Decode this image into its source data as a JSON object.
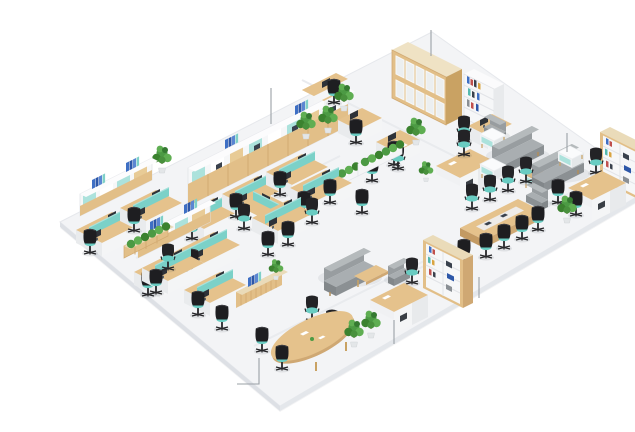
{
  "scene": {
    "type": "3d-isometric-office-render",
    "description": "Isometric 3D rendering of an open-plan office floor: rows of workstations with monitors, teal privacy screens and black task chairs, high storage walls and bookcases, planter hedges, a gray sofa lounge, executive desks, conference and meeting tables on a white floor slab. Thin gray callout lines point at key furniture groups.",
    "background_color": "#ffffff"
  },
  "floor": {
    "points": "20,206 392,16 612,172 240,390",
    "top_color": "#f3f4f6",
    "edge_color": "#e0e3e8"
  },
  "palette": {
    "wood_light": "#e5c28c",
    "wood_mid": "#e2bf88",
    "wood_dark": "#cfa873",
    "white_furniture": "#f4f5f6",
    "teal_accent": "#7bd1c8",
    "teal_light": "#ace2dc",
    "chair_black": "#232326",
    "seat_teal": "#69ccc2",
    "sofa_gray": "#a9aeb1",
    "sofa_gray_dark": "#8b9093",
    "plant_green": "#4c9a44",
    "plant_green_dark": "#357a31",
    "plant_green_light": "#5fae52",
    "binder_blue": "#3e6fc4",
    "monitor_dark": "#2e3238",
    "callout_gray": "#9aa0a6"
  },
  "callouts": [
    {
      "id": "storage-wall",
      "points": "231,72 231,108"
    },
    {
      "id": "glass-cabinet",
      "points": "391,14 391,40"
    },
    {
      "id": "lounge-side-table",
      "points": "527,117 527,136"
    },
    {
      "id": "conference-area",
      "points": "439,261 439,282"
    },
    {
      "id": "reception-desk",
      "points": "354,304 354,328"
    },
    {
      "id": "meeting-chairs",
      "points": "197,368 219,368 219,342"
    }
  ],
  "zones": [
    {
      "id": "storage-wall-top-left",
      "label": "High storage wall with team workstations"
    },
    {
      "id": "open-desks-top-center",
      "label": "Open-plan desks, glass-door cabinet and bookcase"
    },
    {
      "id": "workstations-far-left",
      "label": "Workstation rows with overhead shelving and blue binders"
    },
    {
      "id": "team-cluster-center",
      "label": "Cross-shaped desk cluster with planter hedges"
    },
    {
      "id": "lounge-top-right",
      "label": "Lounge with gray sofas, armchairs and side tables"
    },
    {
      "id": "executive-office-right",
      "label": "Executive desk with wooden bookcase wall"
    },
    {
      "id": "conference-area-right",
      "label": "Conference table with task chairs and bookcase"
    },
    {
      "id": "workstations-bottom-left",
      "label": "Workstation group with teal privacy screens"
    },
    {
      "id": "meeting-area-bottom",
      "label": "Meeting table, credenza, sofas, plants and reception desk"
    }
  ]
}
